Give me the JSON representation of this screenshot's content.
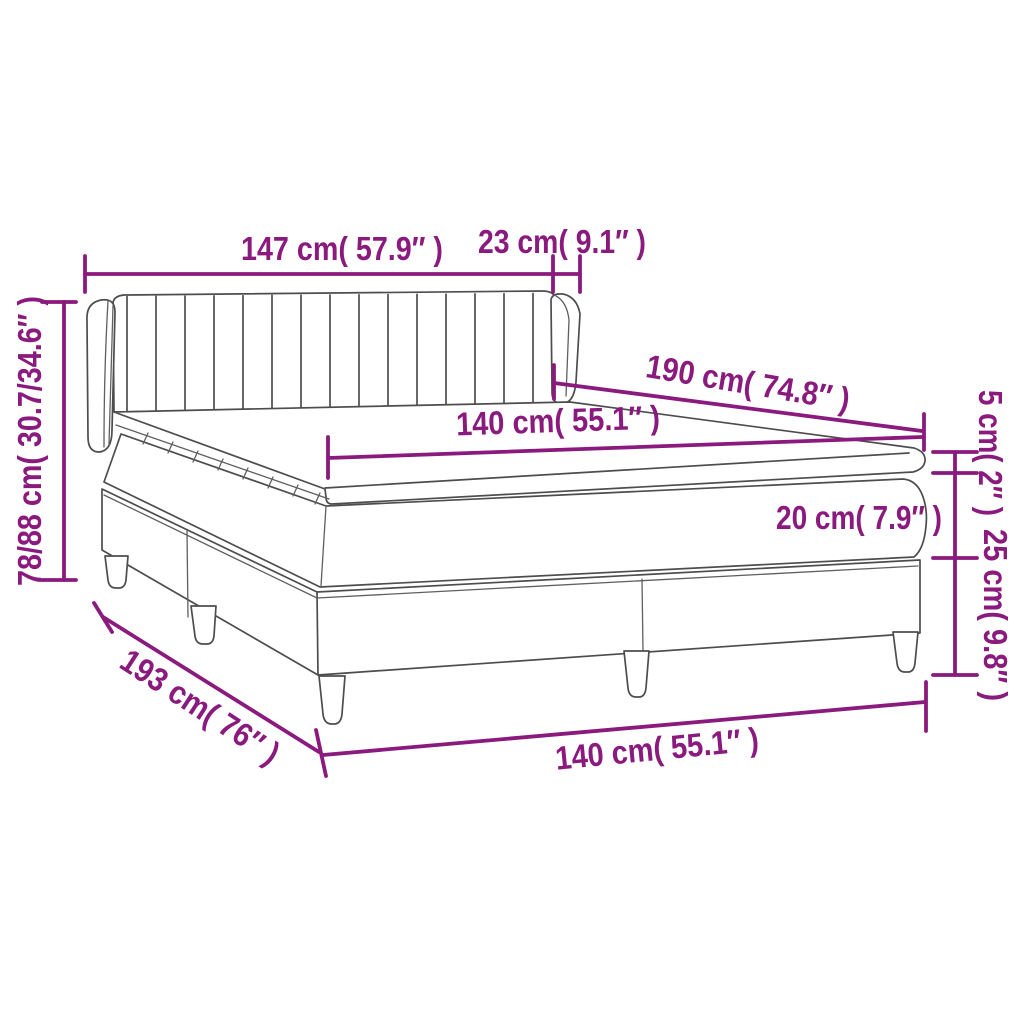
{
  "diagram": {
    "title": "box-spring-bed-dimension-diagram",
    "accent_color": "#8a1a7d",
    "line_color": "#4d4d4d",
    "background_color": "#ffffff",
    "dimensions": {
      "headboard_width": "147 cm( 57.9″ )",
      "headboard_side_depth": "23 cm( 9.1″ )",
      "total_height": "78/88 cm( 30.7/34.6″ )",
      "bed_length": "190 cm( 74.8″ )",
      "mattress_width": "140 cm( 55.1″ )",
      "topper_height": "5 cm( 2″ )",
      "mattress_height": "20 cm( 7.9″ )",
      "base_height": "25 cm( 9.8″ )",
      "total_length": "193 cm( 76″ )",
      "base_width": "140 cm( 55.1″ )"
    }
  }
}
